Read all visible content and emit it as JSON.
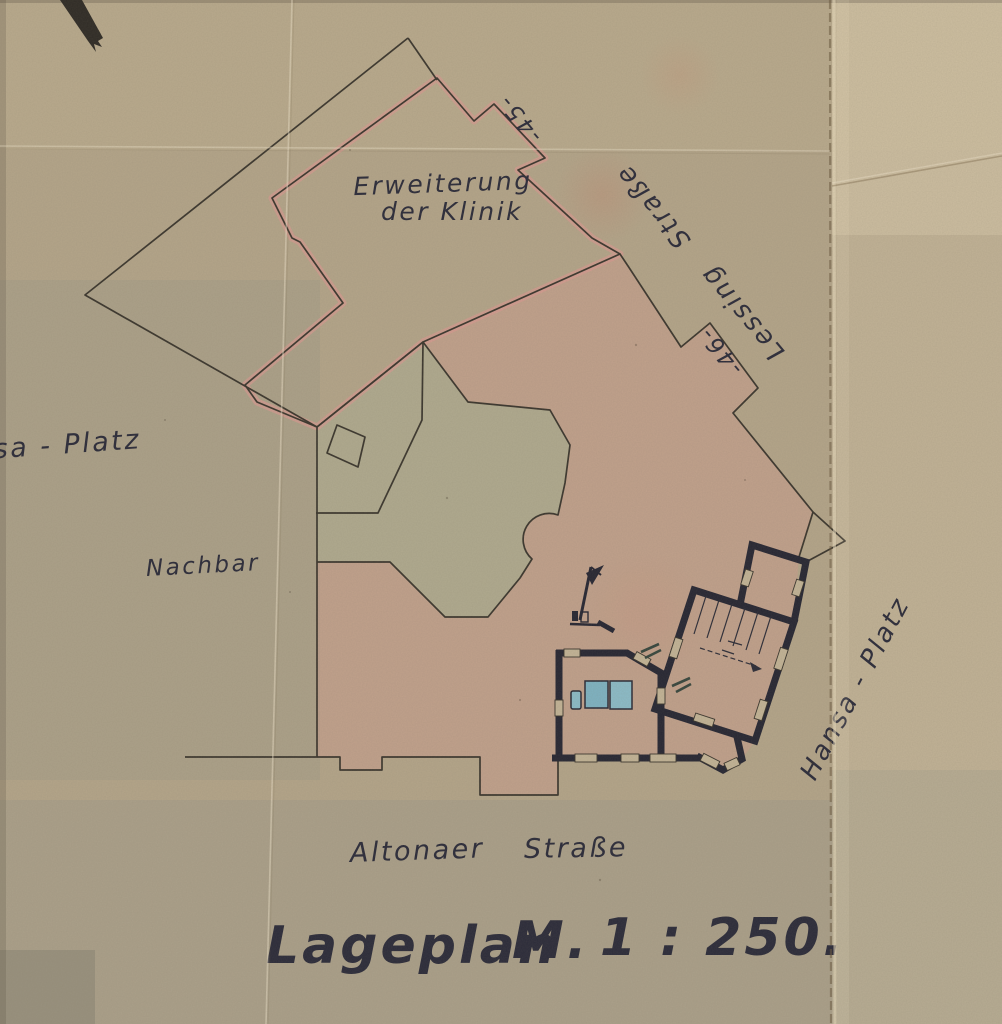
{
  "document": {
    "labels": {
      "extension_line1": "Erweiterung",
      "extension_line2": "der Klinik",
      "street_ne": "Lessing Straße",
      "parcel_45": "-45-",
      "parcel_46": "-46-",
      "square_w": "sa - Platz",
      "neighbor": "Nachbar",
      "square_e": "Hansa - Platz",
      "street_s_word1": "Altonaer",
      "street_s_word2": "Straße",
      "title_word1": "Lageplan",
      "title_word2": "M.",
      "title_word3": "1 : 250."
    },
    "colors": {
      "paper": "#b4a58a",
      "ink": "#2b2b3a",
      "pink_fill": "#d59c8f",
      "pink_band": "#d89a92",
      "wall": "#262633",
      "water_blue": "#8cbcc9",
      "courtyard": "#b0aa8f"
    }
  }
}
